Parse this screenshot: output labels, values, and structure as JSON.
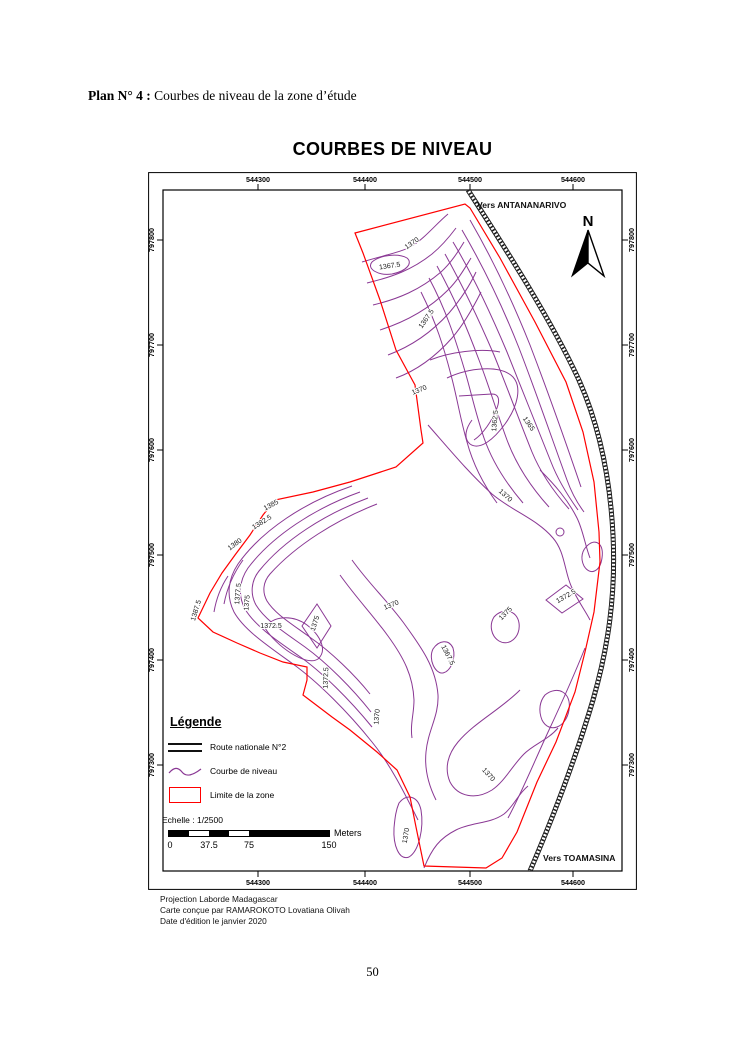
{
  "page": {
    "heading_bold": "Plan N° 4 :",
    "heading_rest": " Courbes de niveau de la zone d’étude",
    "page_number": "50"
  },
  "map": {
    "title": "COURBES DE NIVEAU",
    "direction_labels": {
      "top_right": "Vers ANTANANARIVO",
      "bottom_right": "Vers TOAMASINA"
    },
    "north_label": "N",
    "x_ticks": [
      "544300",
      "544400",
      "544500",
      "544600"
    ],
    "y_ticks": [
      "797800",
      "797700",
      "797600",
      "797500",
      "797400",
      "797300"
    ],
    "contour_labels": [
      {
        "text": "1370"
      },
      {
        "text": "1367.5"
      },
      {
        "text": "1367.5"
      },
      {
        "text": "1370"
      },
      {
        "text": "1362.5"
      },
      {
        "text": "1365"
      },
      {
        "text": "1370"
      },
      {
        "text": "1370"
      },
      {
        "text": "1387.5"
      },
      {
        "text": "1377.5"
      },
      {
        "text": "1375"
      },
      {
        "text": "1380"
      },
      {
        "text": "1382.5"
      },
      {
        "text": "1385"
      },
      {
        "text": "1372.5"
      },
      {
        "text": "1375"
      },
      {
        "text": "1372.5"
      },
      {
        "text": "1367.5"
      },
      {
        "text": "1370"
      },
      {
        "text": "1372.5"
      },
      {
        "text": "1375"
      },
      {
        "text": "1370"
      },
      {
        "text": "1370"
      }
    ],
    "colors": {
      "zone_boundary": "#ff0000",
      "contour": "#8a3894",
      "road": "#1a1a1a"
    }
  },
  "legend": {
    "title": "Légende",
    "items": [
      {
        "label": "Route nationale N°2"
      },
      {
        "label": "Courbe de niveau"
      },
      {
        "label": "Limite de la zone"
      }
    ],
    "scale_text": "Echelle : 1/2500",
    "scalebar": {
      "labels": [
        "0",
        "37.5",
        "75",
        "150"
      ],
      "unit": "Meters"
    }
  },
  "footer": {
    "line1": "Projection Laborde Madagascar",
    "line2": "Carte conçue par RAMAROKOTO Lovatiana Olivah",
    "line3": "Date d'édition le janvier 2020"
  }
}
